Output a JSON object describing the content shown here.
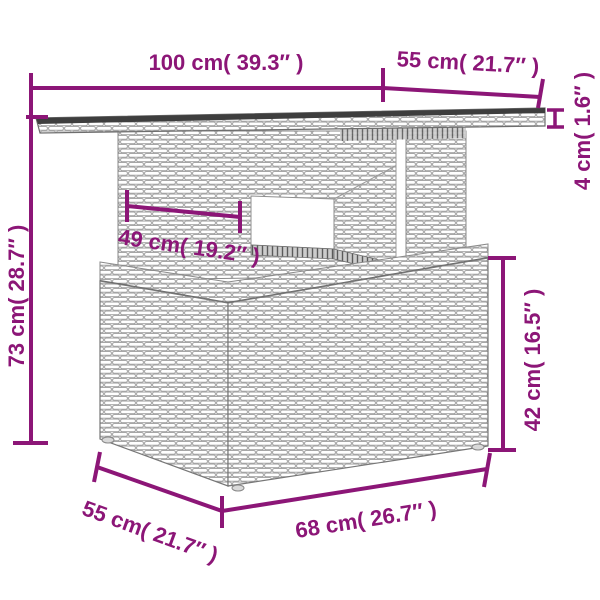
{
  "diagram": {
    "kind": "furniture-dimension-diagram",
    "subject": "poly rattan garden table with storage base",
    "accent_color": "#8C1677",
    "line_art_color": "#8a8a8a",
    "labels": {
      "top_width": "100 cm( 39.3″ )",
      "top_depth": "55 cm( 21.7″ )",
      "tabletop_thickness": "4 cm( 1.6″ )",
      "total_height": "73 cm( 28.7″ )",
      "shelf_width": "49 cm( 19.2″ )",
      "base_height": "42 cm( 16.5″ )",
      "base_depth": "55 cm( 21.7″ )",
      "base_width": "68 cm( 26.7″ )"
    }
  }
}
